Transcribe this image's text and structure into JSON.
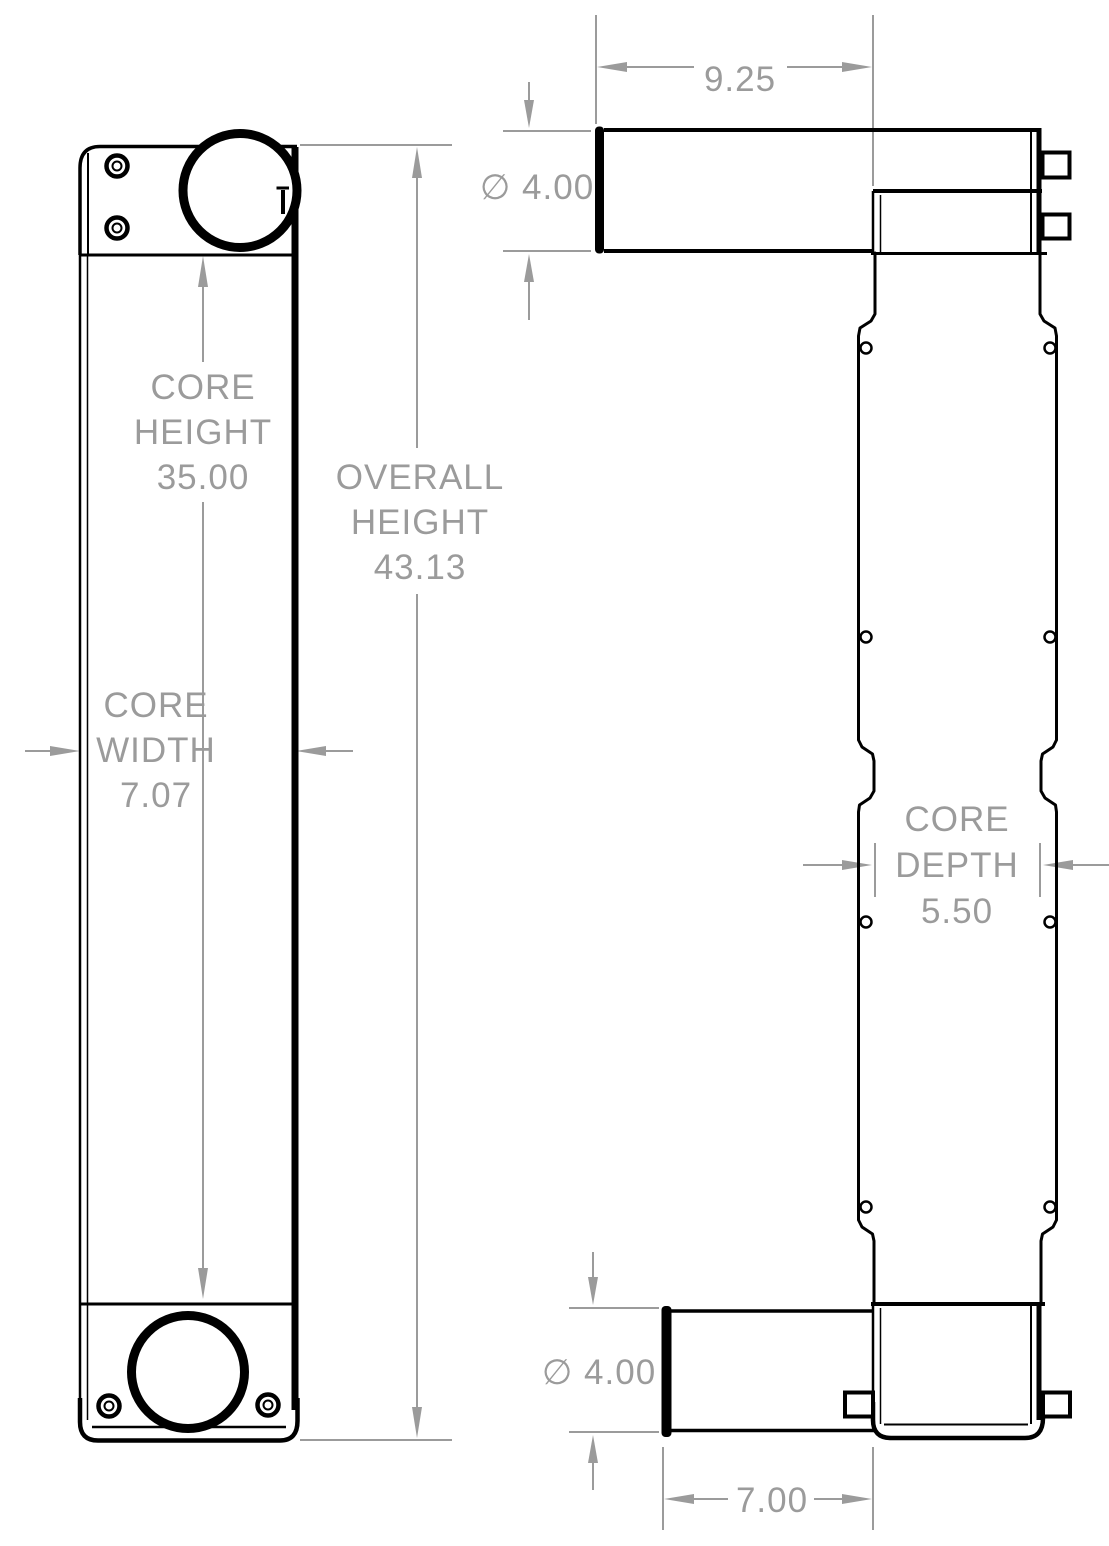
{
  "drawing": {
    "type": "technical-dimension-drawing",
    "views": [
      "front-view",
      "side-view"
    ],
    "colors": {
      "line": "#000000",
      "dimension": "#9b9b9b",
      "background": "#ffffff"
    }
  },
  "dimensions": {
    "core_height": {
      "lines": [
        "CORE",
        "HEIGHT"
      ],
      "value": "35.00"
    },
    "overall_height": {
      "lines": [
        "OVERALL",
        "HEIGHT"
      ],
      "value": "43.13"
    },
    "core_width": {
      "lines": [
        "CORE",
        "WIDTH"
      ],
      "value": "7.07"
    },
    "core_depth": {
      "lines": [
        "CORE",
        "DEPTH"
      ],
      "value": "5.50"
    },
    "top_tube_length": {
      "value": "9.25"
    },
    "top_tube_diameter": {
      "value": "∅ 4.00"
    },
    "bottom_tube_diameter": {
      "value": "∅ 4.00"
    },
    "bottom_tube_length": {
      "value": "7.00"
    }
  }
}
